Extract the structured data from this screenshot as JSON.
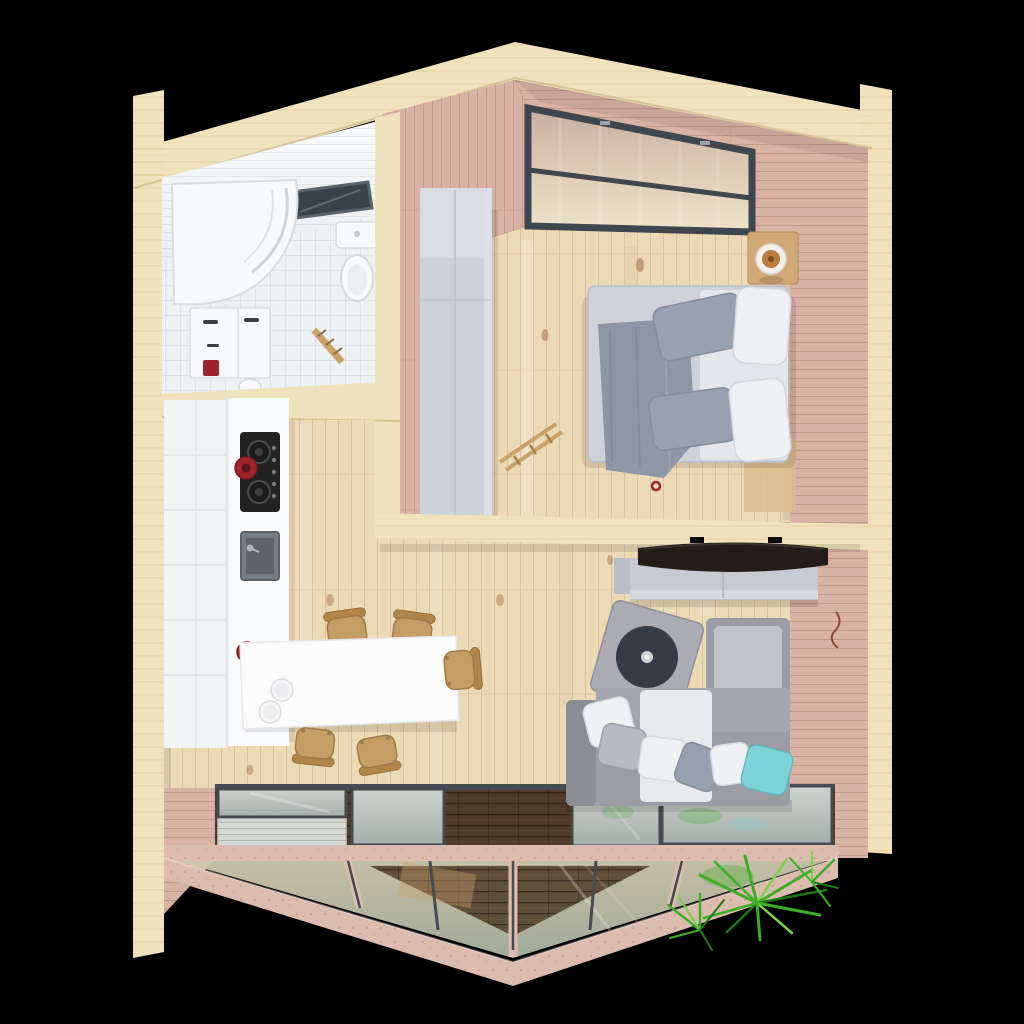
{
  "meta": {
    "scene_type": "3d-floor-plan-cutaway-render",
    "view": "top-down axonometric",
    "background": "solid black"
  },
  "colors": {
    "background": "#000000",
    "wall_cream": "#f0e2bd",
    "wood_pink": "#d8b2a4",
    "floor_pine": "#ecd9b6",
    "bath_white": "#eef1f3",
    "bath_ceiling": "#f6f8fa",
    "fixture_white": "#f8f9fa",
    "cooktop_black": "#222222",
    "sink_gray": "#767d85",
    "accent_red": "#9e232d",
    "chair_tan": "#c59e66",
    "island_white": "#fbfbfc",
    "wardrobe_gray": "#ccd1d9",
    "bed_gray": "#cdd1d9",
    "blanket_gray": "#8d96a5",
    "pillow_gray": "#98a1b0",
    "pillow_white": "#eff0f3",
    "table_tan": "#d2a877",
    "lamp_tan": "#b97c3e",
    "tv_dark": "#241c16",
    "console_gray": "#c7cbd1",
    "sofa_gray": "#9b9ca4",
    "sofa_light": "#c0c2ca",
    "armchair_gray": "#aaabb3",
    "armchair_dark": "#353b47",
    "pillow_teal": "#7ed3d8",
    "window_frame": "#3f464d",
    "glass_frame": "#454b51",
    "timber_pink": "#dcbcae",
    "deck_brown": "#4f3b28",
    "slat_gray": "#d6d8d4",
    "palm_green": "#3fae27"
  },
  "scene": {
    "rooms": [
      {
        "name": "bathroom",
        "position": "top-left",
        "items": [
          "corner-shower",
          "toilet",
          "vanity-cabinet",
          "washbasin",
          "ceiling-window",
          "towel-ladder",
          "red-accent-box"
        ]
      },
      {
        "name": "bedroom",
        "position": "top-right",
        "items": [
          "clerestory-window",
          "double-bed",
          "gray-blanket",
          "gray-pillows",
          "white-pillows",
          "wardrobe",
          "bedside-table",
          "table-lamp",
          "wooden-ladder",
          "rug"
        ]
      },
      {
        "name": "kitchen-dining",
        "position": "left-middle",
        "items": [
          "wall-cabinets",
          "countertop",
          "cooktop",
          "red-pot",
          "kitchen-sink",
          "red-kettle",
          "island-table",
          "plates",
          "wooden-chairs-x5"
        ]
      },
      {
        "name": "living-room",
        "position": "right-middle",
        "items": [
          "wall-tv",
          "media-console",
          "corner-sofa",
          "throw-pillows",
          "teal-pillow",
          "round-armchair"
        ]
      },
      {
        "name": "front-terrace",
        "position": "bottom",
        "items": [
          "glass-floor-panels",
          "white-slat-decking",
          "dark-wood-deck",
          "sloped-glazed-prow",
          "timber-mullions",
          "palm-plant"
        ]
      }
    ]
  }
}
